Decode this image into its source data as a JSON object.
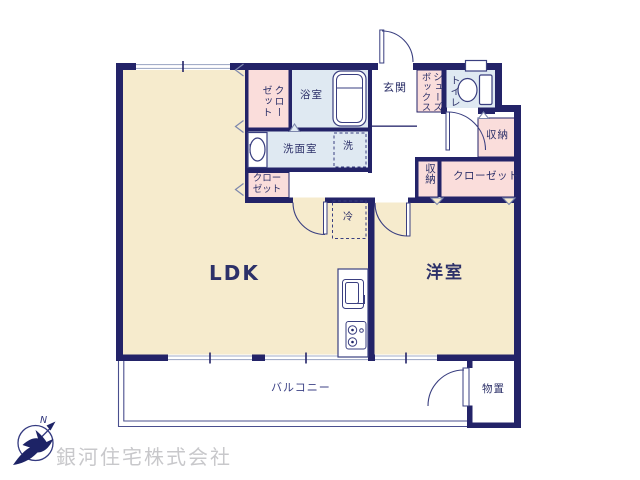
{
  "labels": {
    "ldk": "LDK",
    "western_room": "洋室",
    "entrance": "玄関",
    "bathroom": "浴室",
    "washroom": "洗面室",
    "laundry": "洗",
    "fridge": "冷",
    "closet_top": "クローゼット",
    "closet_mid": "クロー\nゼット",
    "shoes_box": "シューズボックス",
    "toilet": "トイレ",
    "storage_hall": "収納",
    "storage_small": "収納",
    "closet_right": "クローゼット",
    "storage_shed": "物置",
    "balcony": "バルコニー"
  },
  "compass": {
    "north": "N"
  },
  "company": {
    "name": "銀河住宅株式会社"
  },
  "colors": {
    "wall": "#232368",
    "cream": "#f6ebcd",
    "pink": "#fadddb",
    "blue": "#dfe9f2",
    "ink": "#2d3169",
    "window_line": "#a3adc8",
    "balcony_line": "#4a4f8e",
    "chevron": "#7d87ad",
    "company_gray": "#c8c8cb",
    "compass_navy": "#1d2366"
  }
}
